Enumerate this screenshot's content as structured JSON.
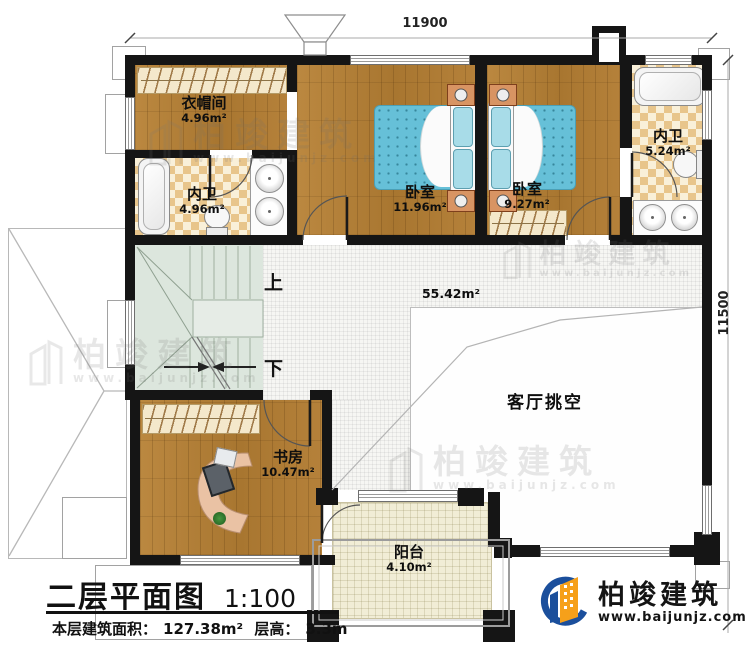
{
  "plan": {
    "title": "二层平面图",
    "scale": "1:100",
    "floor_area_label": "本层建筑面积：",
    "floor_area_value": "127.38m²",
    "floor_height_label": "层高：",
    "floor_height_value": "3.3m"
  },
  "dimensions": {
    "top_width": "11900",
    "right_height": "11500"
  },
  "rooms": {
    "cloakroom": {
      "name": "衣帽间",
      "area": "4.96m²"
    },
    "bath_left": {
      "name": "内卫",
      "area": "4.96m²"
    },
    "bedroom_left": {
      "name": "卧室",
      "area": "11.96m²"
    },
    "bedroom_right": {
      "name": "卧室",
      "area": "9.27m²"
    },
    "bath_right": {
      "name": "内卫",
      "area": "5.24m²"
    },
    "hall": {
      "area": "55.42m²"
    },
    "study": {
      "name": "书房",
      "area": "10.47m²"
    },
    "balcony": {
      "name": "阳台",
      "area": "4.10m²"
    },
    "living_void": {
      "name": "客厅挑空"
    }
  },
  "stairs": {
    "up": "上",
    "down": "下"
  },
  "watermark": {
    "name": "柏竣建筑",
    "url": "www.baijunjz.com"
  },
  "logo": {
    "name": "柏竣建筑",
    "url": "www.baijunjz.com"
  },
  "colors": {
    "wall": "#151515",
    "wood_floor": "#b0803a",
    "tile_accent": "#e8c58b",
    "bed": "#66c0d8",
    "stairs": "#dce6dd",
    "logo_blue": "#1b4f9c",
    "logo_orange": "#f6a01a"
  }
}
